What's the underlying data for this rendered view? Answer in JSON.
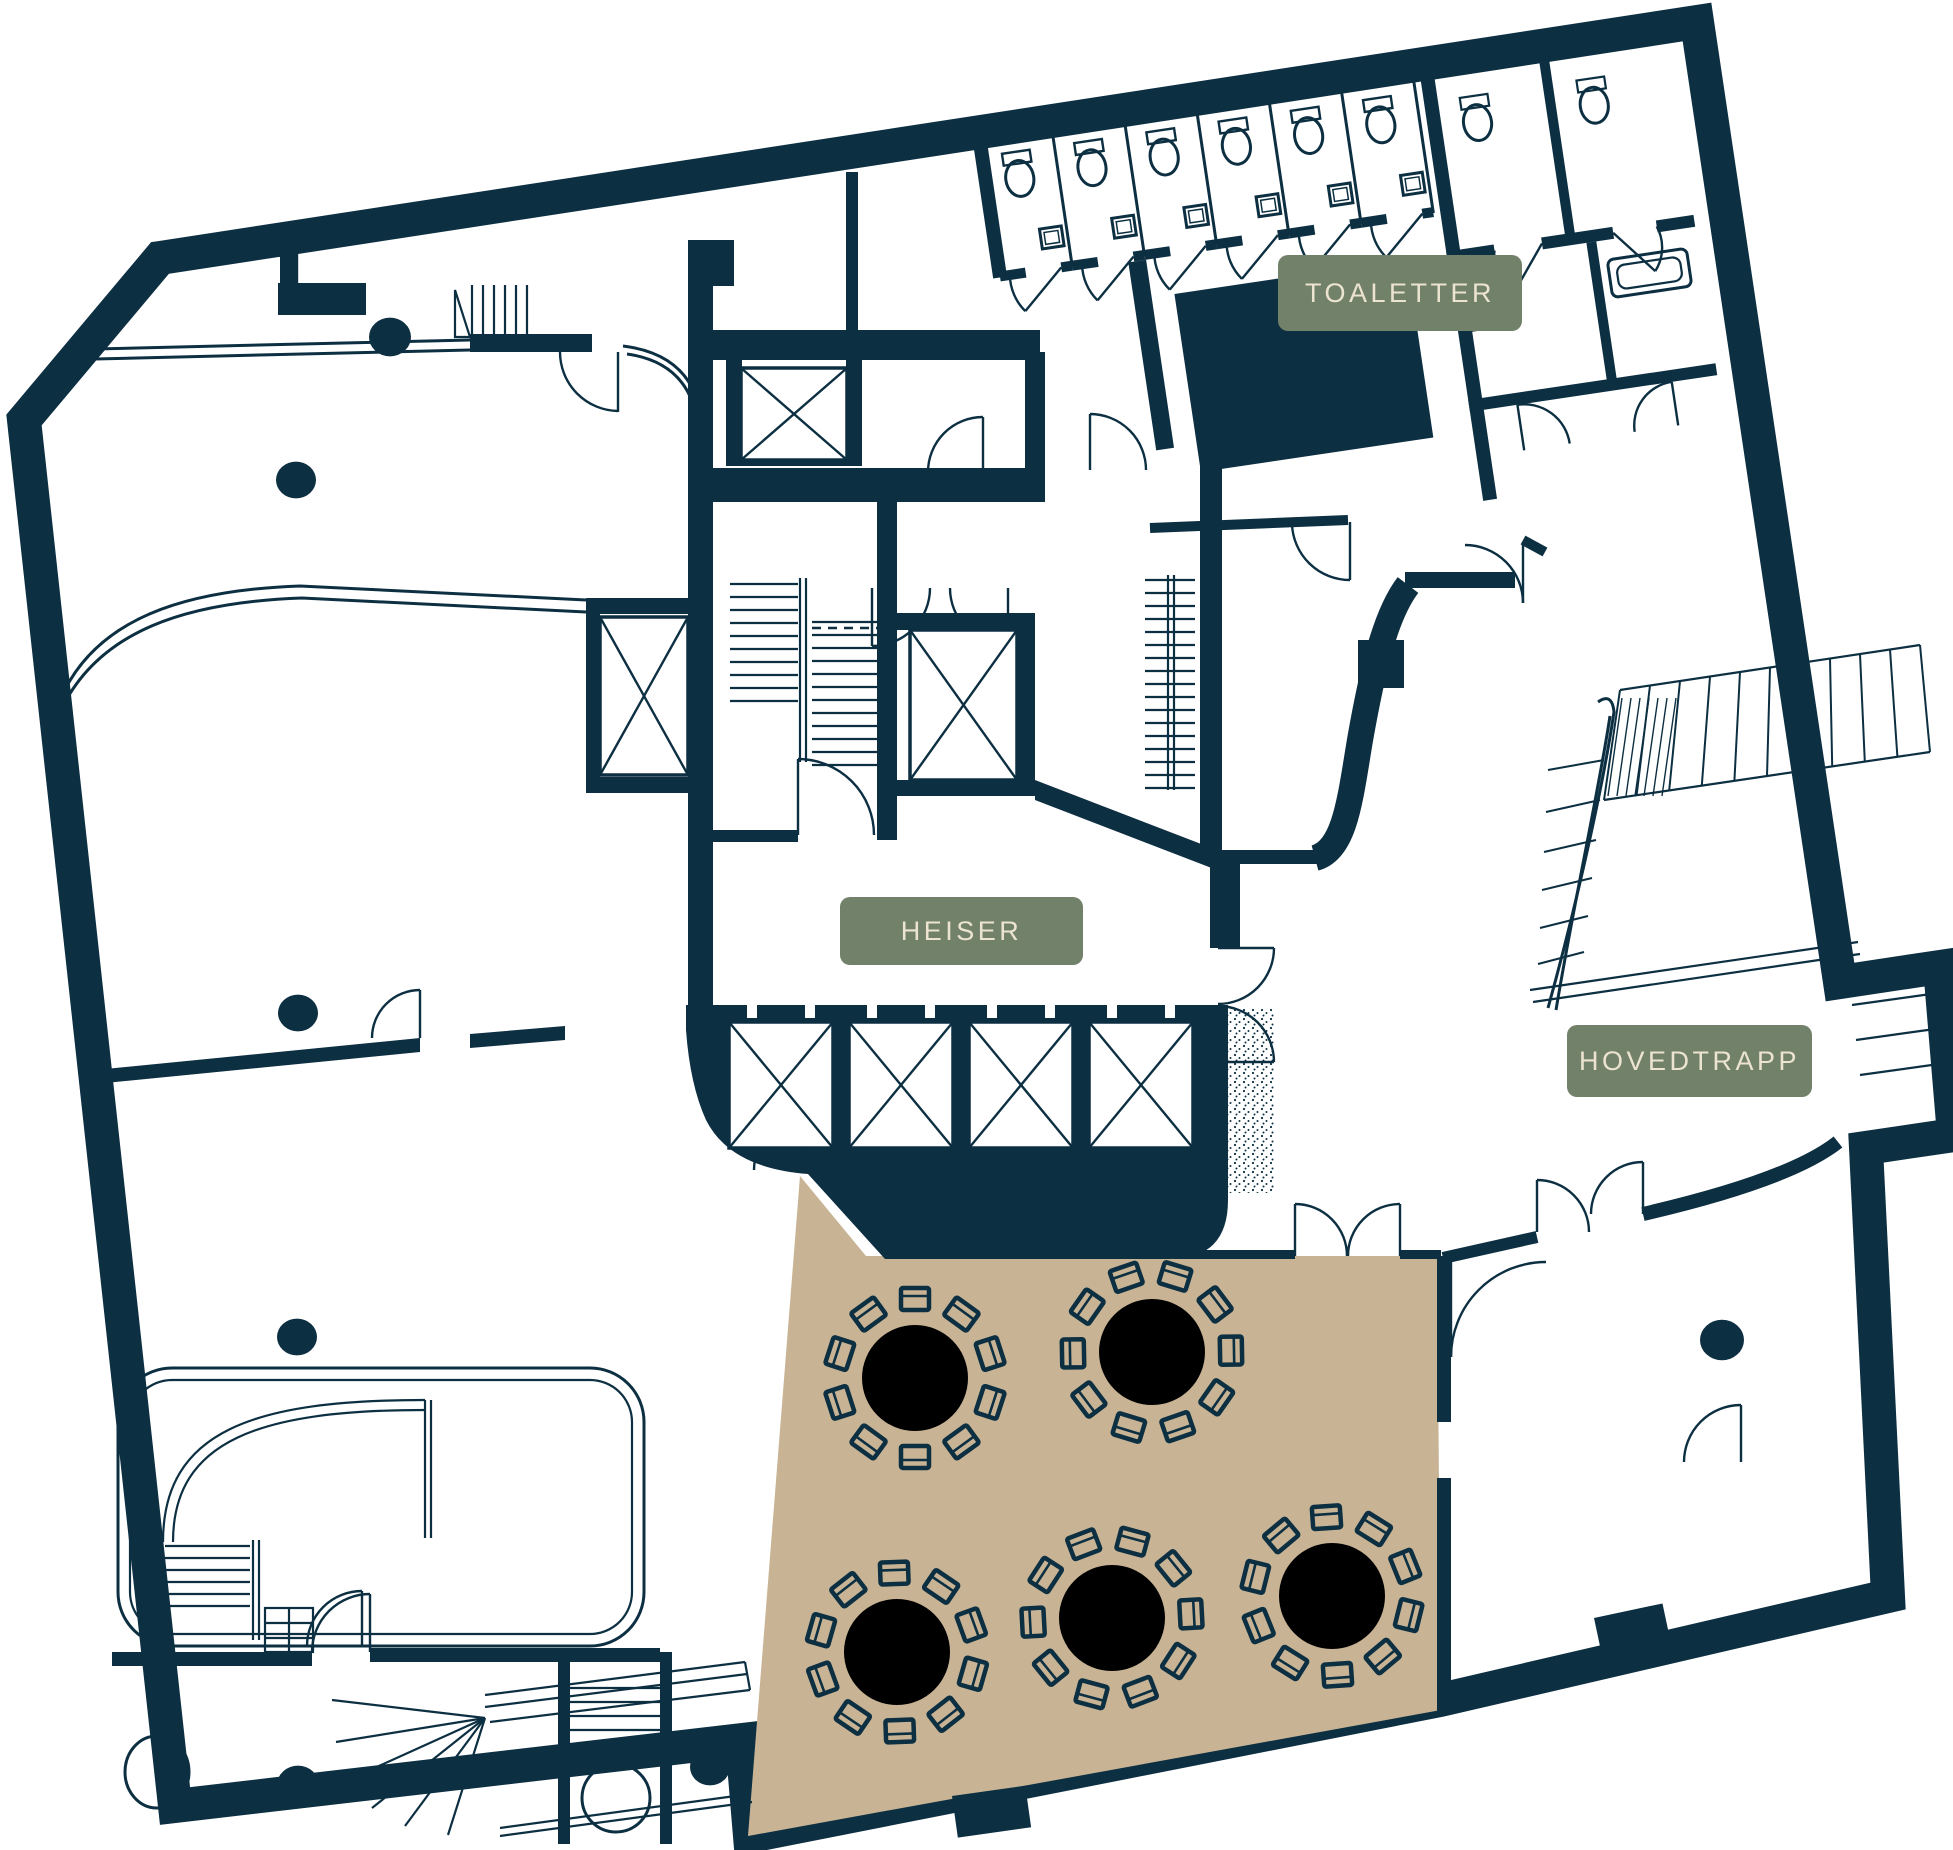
{
  "plan": {
    "name": "etasjeplan",
    "canvas": {
      "width": 1953,
      "height": 1850
    }
  },
  "labels": {
    "toilets": "TOALETTER",
    "elevators": "HEISER",
    "main_stair": "HOVEDTRAPP"
  },
  "colors": {
    "wall": "#0d2f42",
    "floor": "#ffffff",
    "dining_floor": "#c8b495",
    "table": "#a9713f",
    "badge_bg": "#72816a",
    "badge_text": "#ece4d0"
  },
  "dining_area": {
    "chairs_per_table": 10,
    "table_radius": 53,
    "chair_ring_radius": 74,
    "tables": [
      {
        "x": 915,
        "y": 1378
      },
      {
        "x": 1152,
        "y": 1352
      },
      {
        "x": 897,
        "y": 1652
      },
      {
        "x": 1112,
        "y": 1618
      },
      {
        "x": 1332,
        "y": 1596
      }
    ]
  },
  "structural_columns": [
    {
      "x": 390,
      "y": 337,
      "r": 21
    },
    {
      "x": 296,
      "y": 480,
      "r": 20
    },
    {
      "x": 298,
      "y": 1013,
      "r": 20
    },
    {
      "x": 297,
      "y": 1337,
      "r": 20
    },
    {
      "x": 298,
      "y": 1785,
      "r": 21
    },
    {
      "x": 710,
      "y": 1767,
      "r": 20
    },
    {
      "x": 1722,
      "y": 1340,
      "r": 22
    }
  ],
  "elevators": {
    "bottom_row": {
      "y": 1022,
      "w": 104,
      "h": 126,
      "xs": [
        729,
        849,
        969,
        1089
      ]
    },
    "other_shafts": [
      {
        "x": 600,
        "y": 617,
        "w": 88,
        "h": 158
      },
      {
        "x": 741,
        "y": 368,
        "w": 106,
        "h": 92
      },
      {
        "x": 910,
        "y": 630,
        "w": 107,
        "h": 150
      }
    ]
  },
  "toilets": {
    "top_row": {
      "count": 6,
      "x_start": 1095,
      "pitch": 73,
      "y_top": 150,
      "y_bottom": 287
    }
  }
}
